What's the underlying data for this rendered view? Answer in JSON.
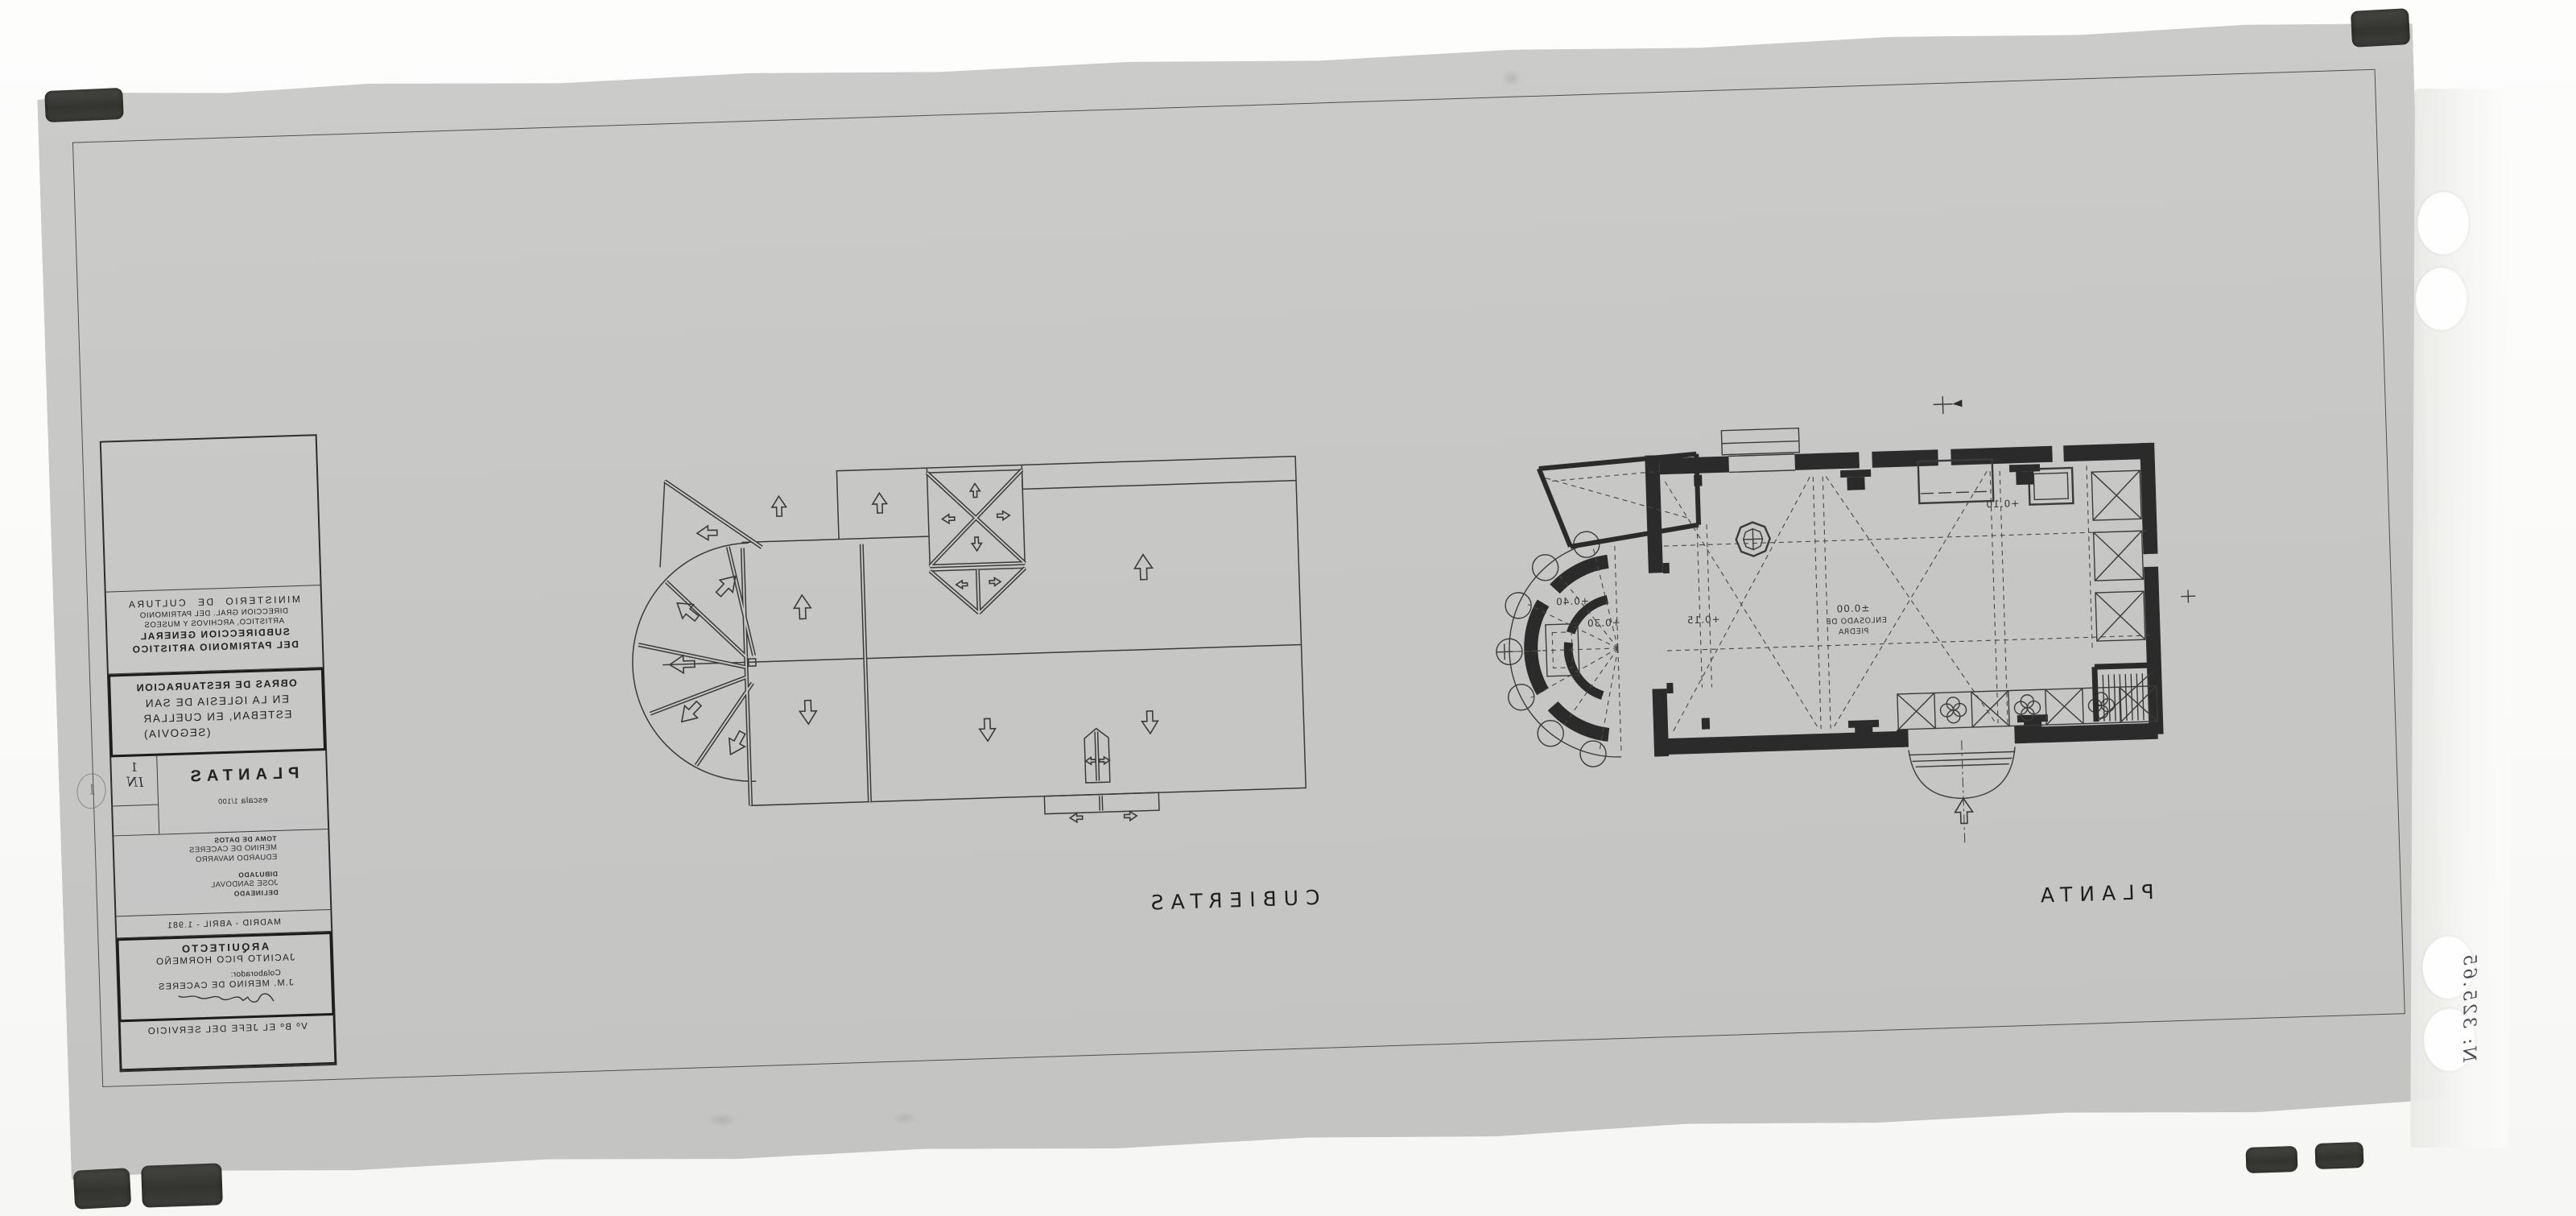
{
  "title_block": {
    "ministry_line1": "MINISTERIO DE CULTURA",
    "ministry_line2": "DIRECCION GRAL. DEL PATRIMONIO",
    "ministry_line3": "ARTISTICO, ARCHIVOS Y MUSEOS",
    "subdirection_line1": "SUBDIRECCION GENERAL",
    "subdirection_line2": "DEL PATRIMONIO ARTISTICO",
    "project_line1": "OBRAS DE RESTAURACION",
    "project_line2": "EN LA IGLESIA DE SAN",
    "project_line3": "ESTEBAN, EN CUELLAR",
    "project_line4": "(SEGOVIA)",
    "sheet_number": "1",
    "sheet_number_note": "IN",
    "margin_number": "1",
    "drawing_title": "PLANTAS",
    "scale_label": "escala",
    "scale_value": "1/100",
    "credits": {
      "toma_de_datos_label": "TOMA DE DATOS",
      "toma_name_1": "MERINO DE CACERES",
      "toma_name_2": "EDUARDO NAVARRO",
      "dibujado_label": "DIBUJADO",
      "dibujado_name": "JOSE SANDOVAL",
      "delineado_label": "DELINEADO"
    },
    "date_line": "MADRID - ABRIL - 1.981",
    "architect_label": "ARQUITECTO",
    "architect_name": "JACINTO PICO HORMEÑO",
    "collaborator_label": "Colaborador:",
    "collaborator_name": "J.M. MERINO DE CACERES",
    "approval_line": "Vº Bº EL JEFE DEL SERVICIO"
  },
  "plan_labels": {
    "roof": "CUBIERTAS",
    "floor": "PLANTA"
  },
  "floor_levels": {
    "apse_upper": "+0.40",
    "apse_lower": "+0.30",
    "presbytery": "+0.15",
    "nave_level": "±0.00",
    "nave_note_1": "ENLOSADO DE",
    "nave_note_2": "PIEDRA",
    "sacristy": "+0.10"
  },
  "annotations": {
    "archive_number": "N: 325.65"
  },
  "colors": {
    "sheet": "#c7c7c5",
    "line": "#3a3a3a",
    "wall": "#2b2b2b",
    "clip": "#3a3a38"
  }
}
